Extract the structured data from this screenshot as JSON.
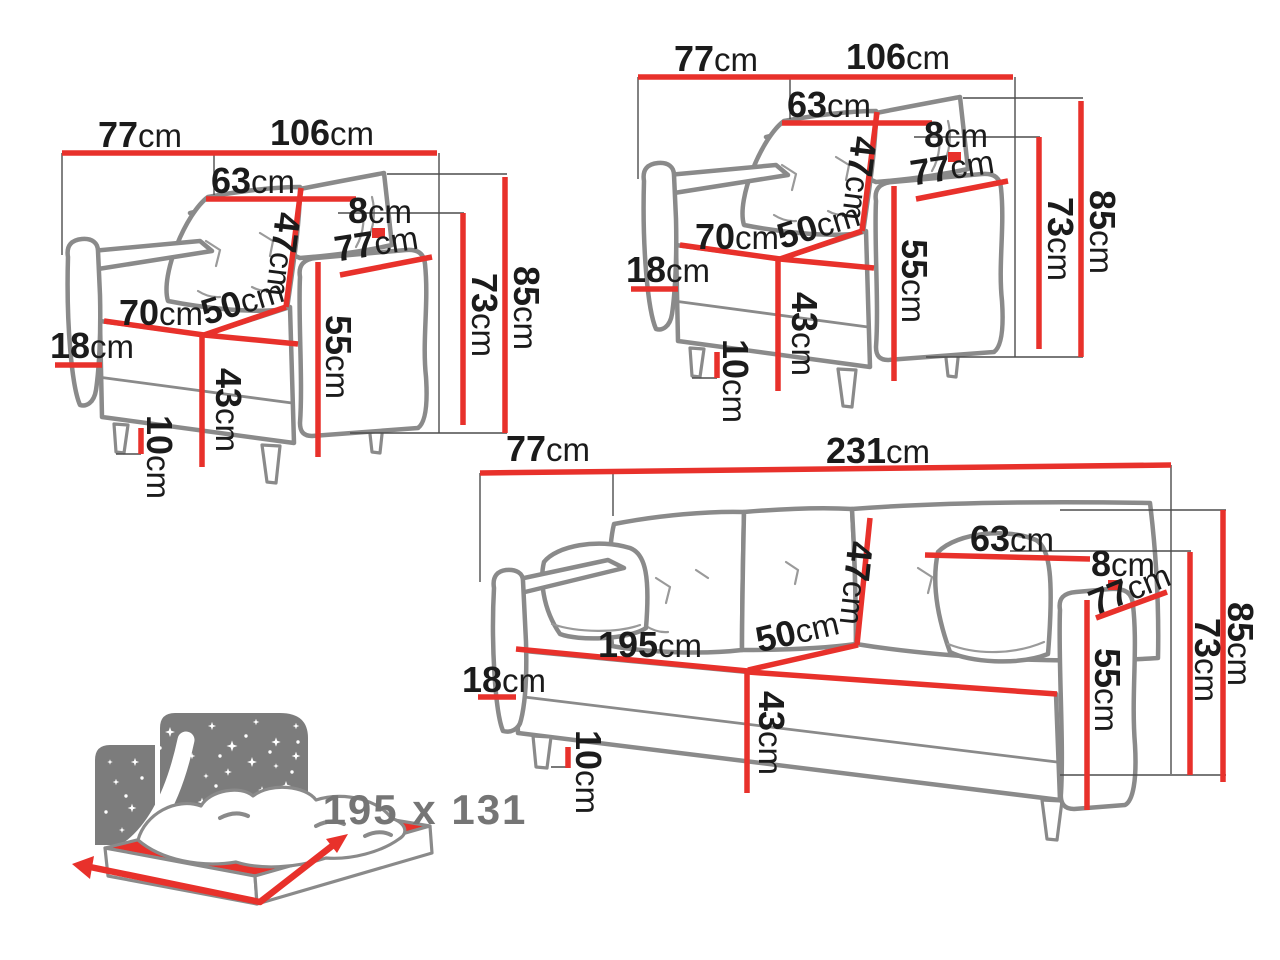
{
  "page": {
    "background": "#ffffff",
    "type": "furniture-dimensions-sheet"
  },
  "unit": "cm",
  "colors": {
    "dimension_line_red": "#e8312b",
    "furniture_outline_gray": "#8a8a8a",
    "reference_line_gray": "#4d4d4d",
    "label_text": "#1b1b1b",
    "icon_gray": "#7c7c7c",
    "icon_label_gray": "#757575"
  },
  "armchair": {
    "back_width": "77",
    "total_width": "106",
    "cushion_width": "63",
    "back_gap": "8",
    "cushion_height": "47",
    "arm_depth": "77",
    "seat_width": "70",
    "seat_depth": "50",
    "arm_height": "55",
    "base_height": "18",
    "seat_height": "43",
    "leg_height": "10",
    "backrest_height": "73",
    "total_height": "85"
  },
  "sofa": {
    "back_width": "77",
    "total_width": "231",
    "cushion_width": "63",
    "back_gap": "8",
    "cushion_height": "47",
    "arm_depth": "77",
    "seat_width": "195",
    "seat_depth": "50",
    "arm_height": "55",
    "base_height": "18",
    "seat_height": "43",
    "leg_height": "10",
    "backrest_height": "73",
    "total_height": "85"
  },
  "sleeping_icon": {
    "dimensions_label": "195 x 131"
  }
}
